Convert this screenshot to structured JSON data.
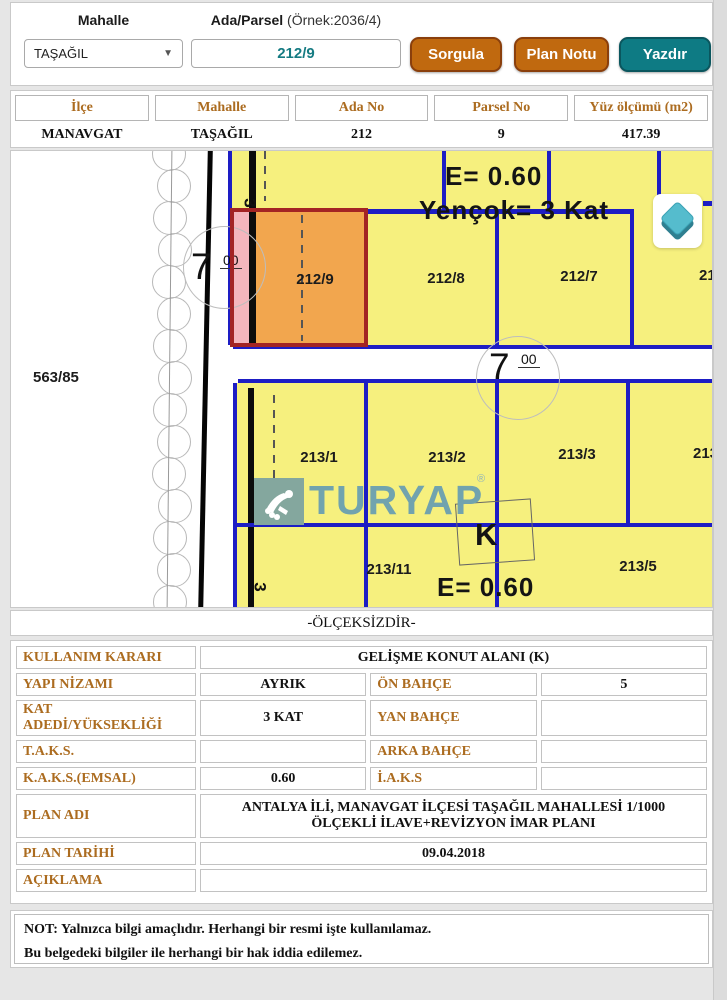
{
  "header": {
    "mahalle_label": "Mahalle",
    "mahalle_value": "TAŞAĞIL",
    "ada_parsel_label": "Ada/Parsel",
    "ada_parsel_hint": "(Örnek:2036/4)",
    "ada_parsel_value": "212/9",
    "buttons": {
      "sorgula": "Sorgula",
      "plan_notu": "Plan Notu",
      "yazdir": "Yazdır"
    }
  },
  "result_table": {
    "headers": [
      "İlçe",
      "Mahalle",
      "Ada No",
      "Parsel No",
      "Yüz ölçümü (m2)"
    ],
    "values": [
      "MANAVGAT",
      "TAŞAĞIL",
      "212",
      "9",
      "417.39"
    ]
  },
  "map": {
    "labels": {
      "p563": "563/85",
      "p212_9": "212/9",
      "p212_8": "212/8",
      "p212_7": "212/7",
      "p212_6": "212",
      "p213_1": "213/1",
      "p213_2": "213/2",
      "p213_3": "213/3",
      "p213_4": "213/4",
      "p213_11": "213/11",
      "p213_5": "213/5",
      "e_top": "E= 0.60",
      "yencok": "Yençok= 3 Kat",
      "e_bottom": "E= 0.60",
      "k": "K",
      "road_7": "7",
      "road_00": "00",
      "width_3": "3"
    },
    "watermark": {
      "text": "TURYAP",
      "reg": "®"
    },
    "colors": {
      "parcel_yellow": "#f6f07e",
      "line_blue": "#1d1dc4",
      "highlight_orange": "#f2a64e",
      "highlight_pink": "#f4b6bd",
      "highlight_border": "#a32424",
      "watermark_teal": "#71a3ae"
    }
  },
  "scale_note": "-ÖLÇEKSİZDİR-",
  "info_table": {
    "r1": {
      "label": "KULLANIM KARARI",
      "value": "GELİŞME KONUT ALANI (K)"
    },
    "r2": {
      "label": "YAPI NİZAMI",
      "value": "AYRIK",
      "label2": "ÖN BAHÇE",
      "value2": "5"
    },
    "r3": {
      "label": "KAT ADEDİ/YÜKSEKLİĞİ",
      "value": "3 KAT",
      "label2": "YAN BAHÇE",
      "value2": ""
    },
    "r4": {
      "label": "T.A.K.S.",
      "value": "",
      "label2": "ARKA BAHÇE",
      "value2": ""
    },
    "r5": {
      "label": "K.A.K.S.(EMSAL)",
      "value": "0.60",
      "label2": "İ.A.K.S",
      "value2": ""
    },
    "r6": {
      "label": "PLAN ADI",
      "value": "ANTALYA İLİ, MANAVGAT İLÇESİ TAŞAĞIL MAHALLESİ 1/1000 ÖLÇEKLİ İLAVE+REVİZYON İMAR PLANI"
    },
    "r7": {
      "label": "PLAN TARİHİ",
      "value": "09.04.2018"
    },
    "r8": {
      "label": "AÇIKLAMA",
      "value": ""
    }
  },
  "note": {
    "line1": "NOT: Yalnızca bilgi amaçlıdır. Herhangi bir resmi işte kullanılamaz.",
    "line2": "Bu belgedeki bilgiler ile herhangi bir hak iddia edilemez."
  }
}
